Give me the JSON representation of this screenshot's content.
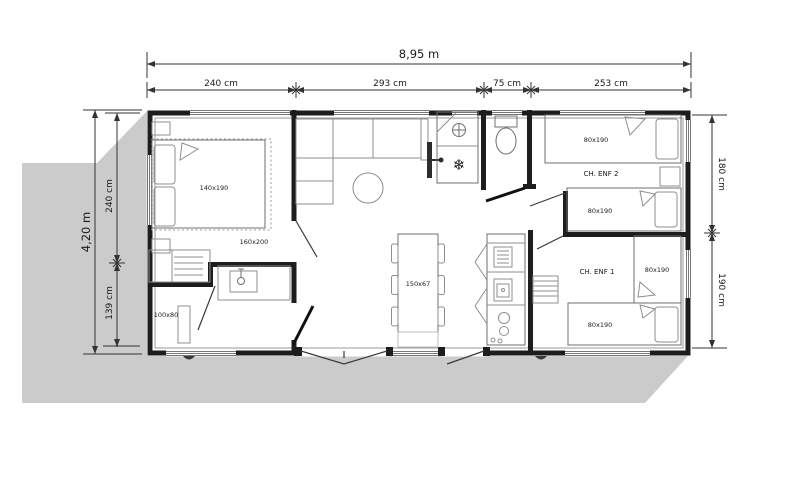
{
  "plan": {
    "dimensions": {
      "overall_width": "8,95 m",
      "overall_height": "4,20 m",
      "top_segments": [
        "240 cm",
        "293 cm",
        "75 cm",
        "253 cm"
      ],
      "left_segments": [
        "240 cm",
        "139 cm"
      ],
      "right_segments": [
        "180 cm",
        "190 cm"
      ]
    },
    "rooms": {
      "parents_bedroom": {
        "bed": "140x190",
        "bed_zone": "160x200"
      },
      "bathroom": {
        "shower": "100x80"
      },
      "living_kitchen": {
        "dining_table": "150x67"
      },
      "kids_bedroom_2": {
        "name": "CH. ENF 2",
        "beds": [
          "80x190",
          "80x190"
        ]
      },
      "kids_bedroom_1": {
        "name": "CH. ENF 1",
        "beds": [
          "80x190",
          "80x190"
        ]
      }
    },
    "icons": {
      "fridge_snowflake": "❄"
    },
    "colors": {
      "shadow": "#cbcbcb",
      "wall": "#1d1d1d",
      "furniture": "#8f8f8f",
      "dimension": "#333333"
    }
  }
}
